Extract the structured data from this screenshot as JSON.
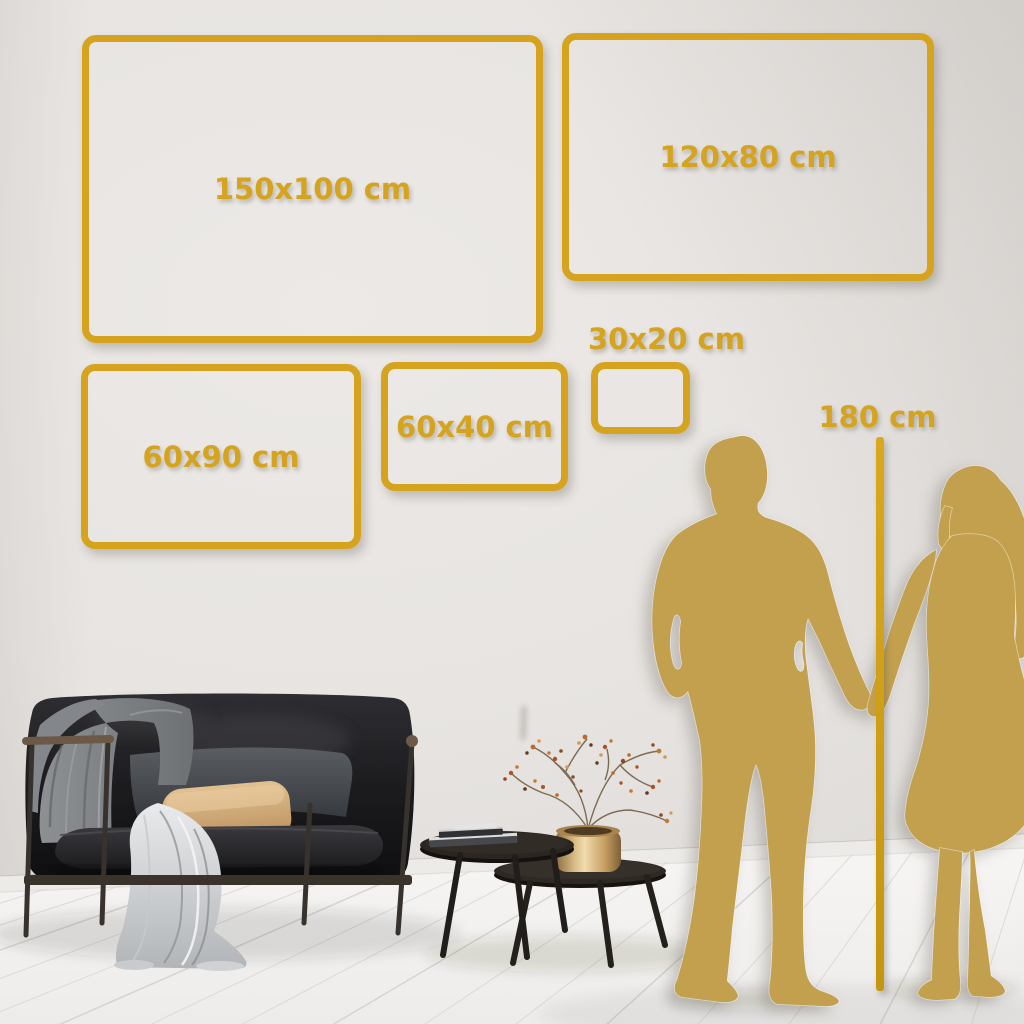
{
  "size_guide": {
    "frames": [
      {
        "label": "150x100 cm"
      },
      {
        "label": "120x80 cm"
      },
      {
        "label": "60x90 cm"
      },
      {
        "label": "60x40 cm"
      },
      {
        "label": "30x20 cm"
      }
    ],
    "height_marker": {
      "label": "180 cm"
    }
  },
  "colors": {
    "accent_gold": "#D5A31D",
    "silhouette_gold": "#C2A04E",
    "wall_gray": "#E7E4E1",
    "floor_white": "#F4F3F1"
  },
  "scene": {
    "objects": [
      "gold-size-frames",
      "man-silhouette",
      "woman-silhouette",
      "height-measure-line",
      "sofa",
      "gray-blanket",
      "throw-fabric",
      "back-cushion",
      "tan-pillow",
      "nesting-coffee-tables",
      "books",
      "brass-vase",
      "dried-branch-plant",
      "plank-floor",
      "plain-wall"
    ]
  }
}
